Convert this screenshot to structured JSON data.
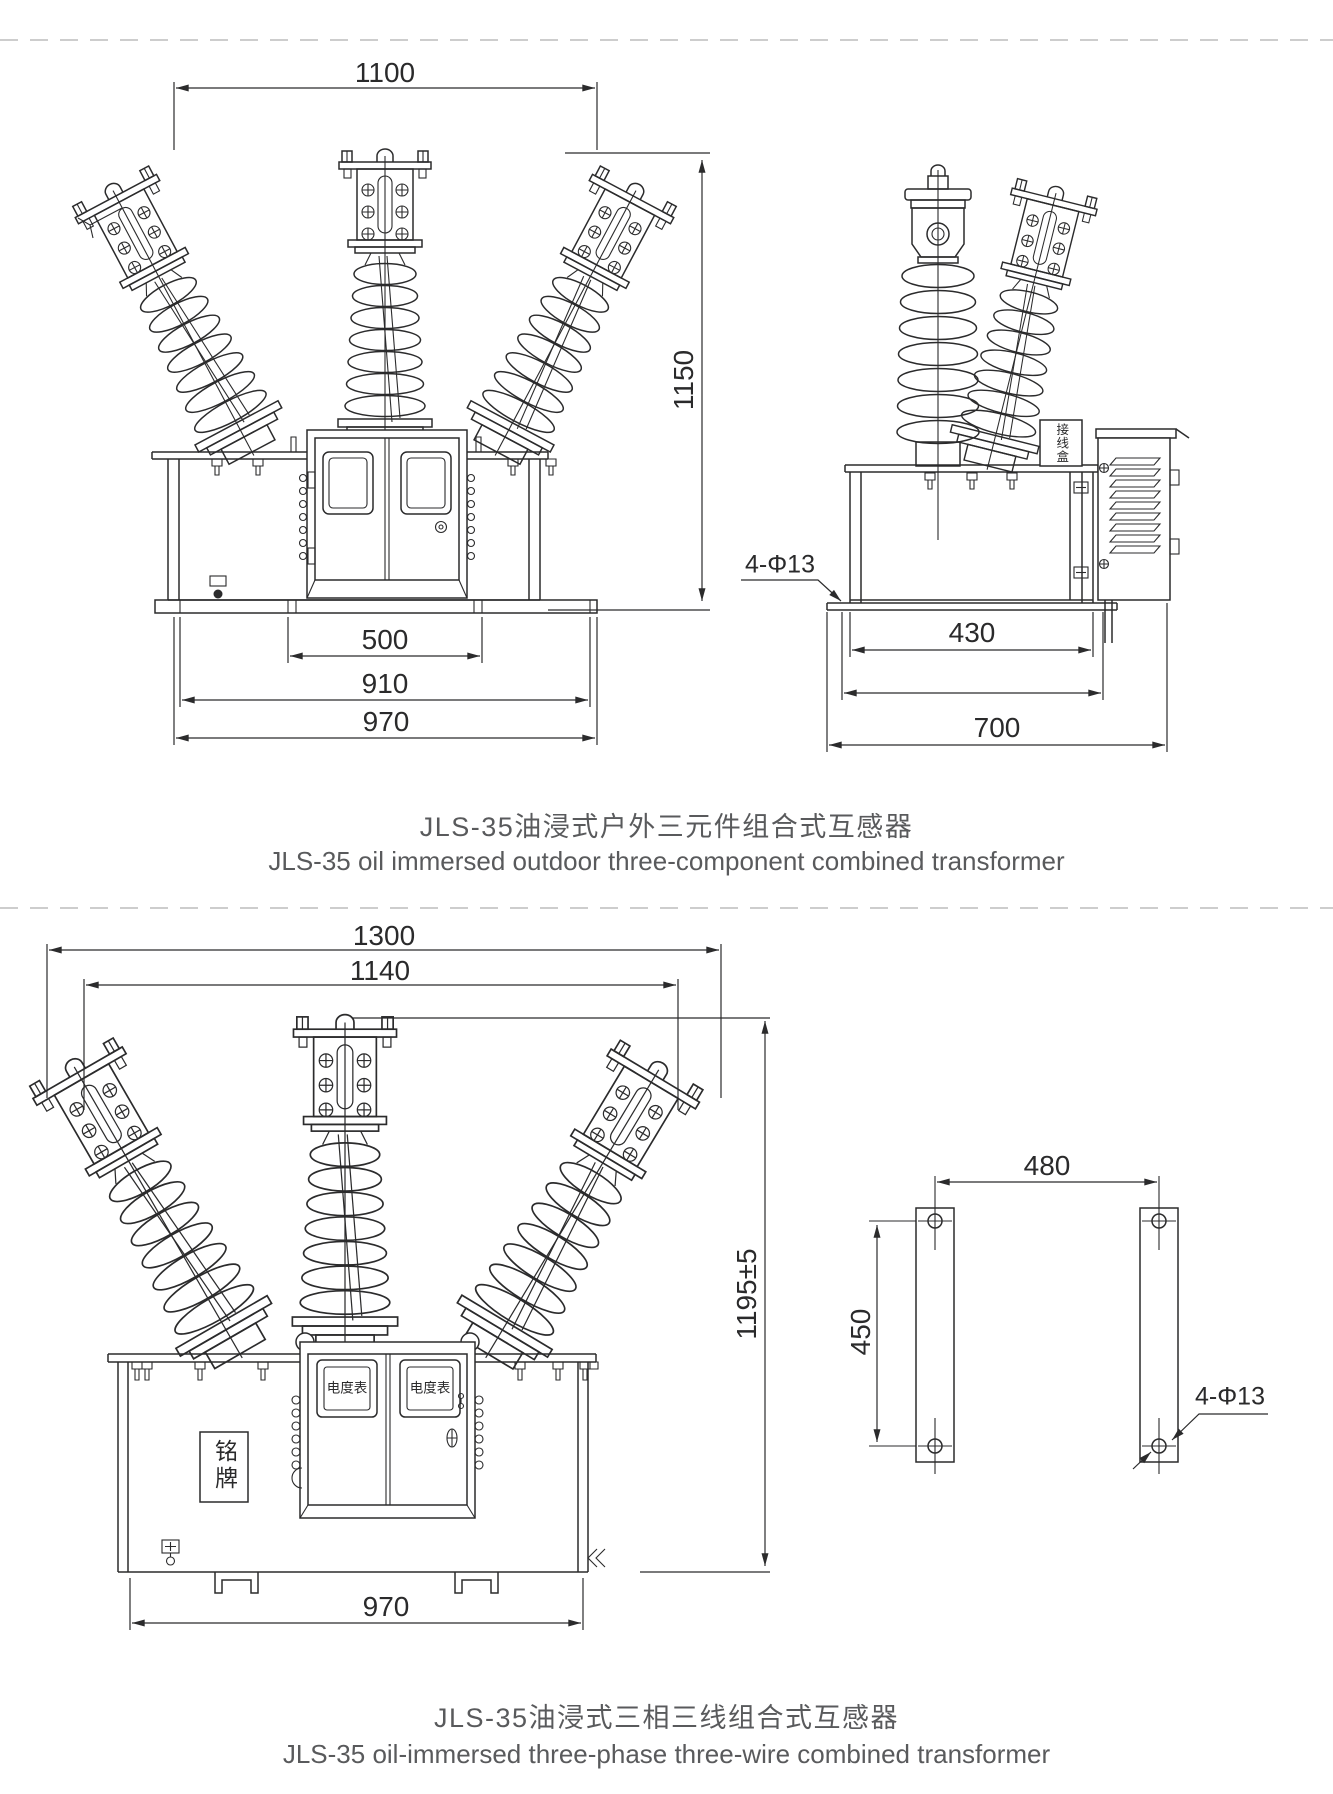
{
  "page": {
    "background": "#ffffff",
    "line_color": "#2b2b2c",
    "title_color": "#595a5c",
    "separator_color": "#cdcdcd"
  },
  "figure1": {
    "title_zh": "JLS-35油浸式户外三元件组合式互感器",
    "title_en": "JLS-35 oil immersed outdoor three-component combined transformer",
    "front_view": {
      "dim_top_width": "1100",
      "dim_height": "1150",
      "dim_mount_slot_width": "500",
      "dim_body_width": "910",
      "dim_base_width": "970"
    },
    "side_view": {
      "dim_inner_width": "430",
      "dim_mount_hole_width": "470",
      "dim_base_width": "700",
      "mount_hole_note": "4-Φ13",
      "junction_box_label": "接线盒"
    }
  },
  "figure2": {
    "title_zh": "JLS-35油浸式三相三线组合式互感器",
    "title_en": "JLS-35 oil-immersed three-phase three-wire combined transformer",
    "front_view": {
      "dim_terminal_span": "1300",
      "dim_arm_span": "1140",
      "dim_height": "1195±5",
      "dim_base_width": "970",
      "meter_window_left_label": "电度表",
      "meter_window_right_label": "电度表",
      "nameplate_label": "铭牌"
    },
    "mount_view": {
      "dim_hole_spacing_horizontal": "480",
      "dim_hole_spacing_vertical": "450",
      "mount_hole_note": "4-Φ13"
    }
  }
}
